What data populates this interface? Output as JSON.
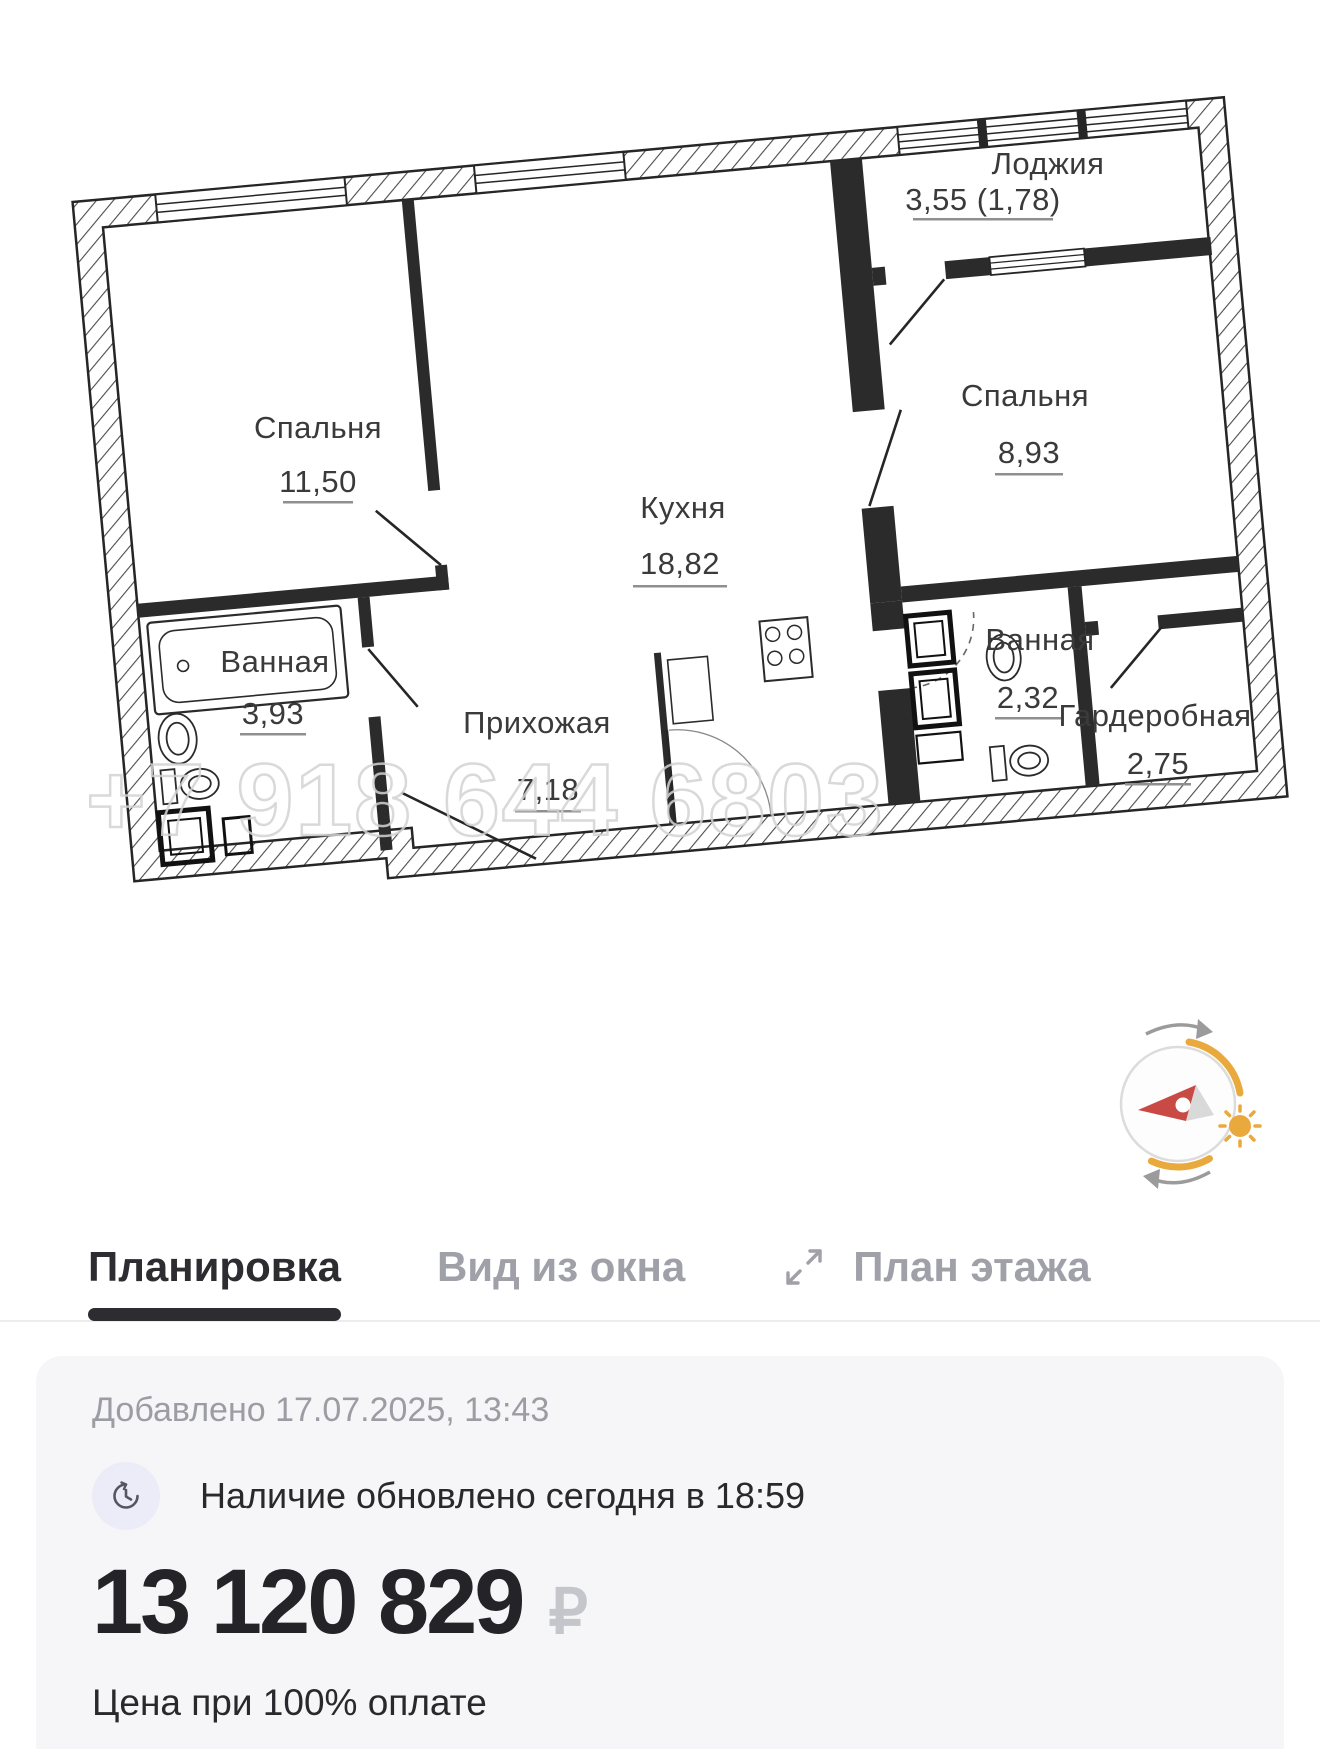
{
  "floorplan": {
    "watermark": "+7 918 644 6803",
    "rooms": [
      {
        "name": "Лоджия",
        "area": "3,55 (1,78)"
      },
      {
        "name": "Спальня",
        "area": "11,50"
      },
      {
        "name": "Кухня",
        "area": "18,82"
      },
      {
        "name": "Спальня",
        "area": "8,93"
      },
      {
        "name": "Ванная",
        "area": "3,93"
      },
      {
        "name": "Прихожая",
        "area": "7,18"
      },
      {
        "name": "Ванная",
        "area": "2,32"
      },
      {
        "name": "Гардеробная",
        "area": "2,75"
      }
    ],
    "colors": {
      "wall_line": "#262626",
      "label": "#3a3a3a",
      "watermark": "#d3d3d3",
      "compass_accent": "#EAA93C",
      "compass_needle": "#C94A45"
    }
  },
  "tabs": {
    "items": [
      {
        "label": "Планировка"
      },
      {
        "label": "Вид из окна"
      },
      {
        "label": "План этажа"
      }
    ]
  },
  "details": {
    "added": "Добавлено 17.07.2025, 13:43",
    "availability": "Наличие обновлено сегодня в 18:59",
    "price": "13 120 829",
    "currency": "₽",
    "price_note": "Цена при 100% оплате"
  }
}
